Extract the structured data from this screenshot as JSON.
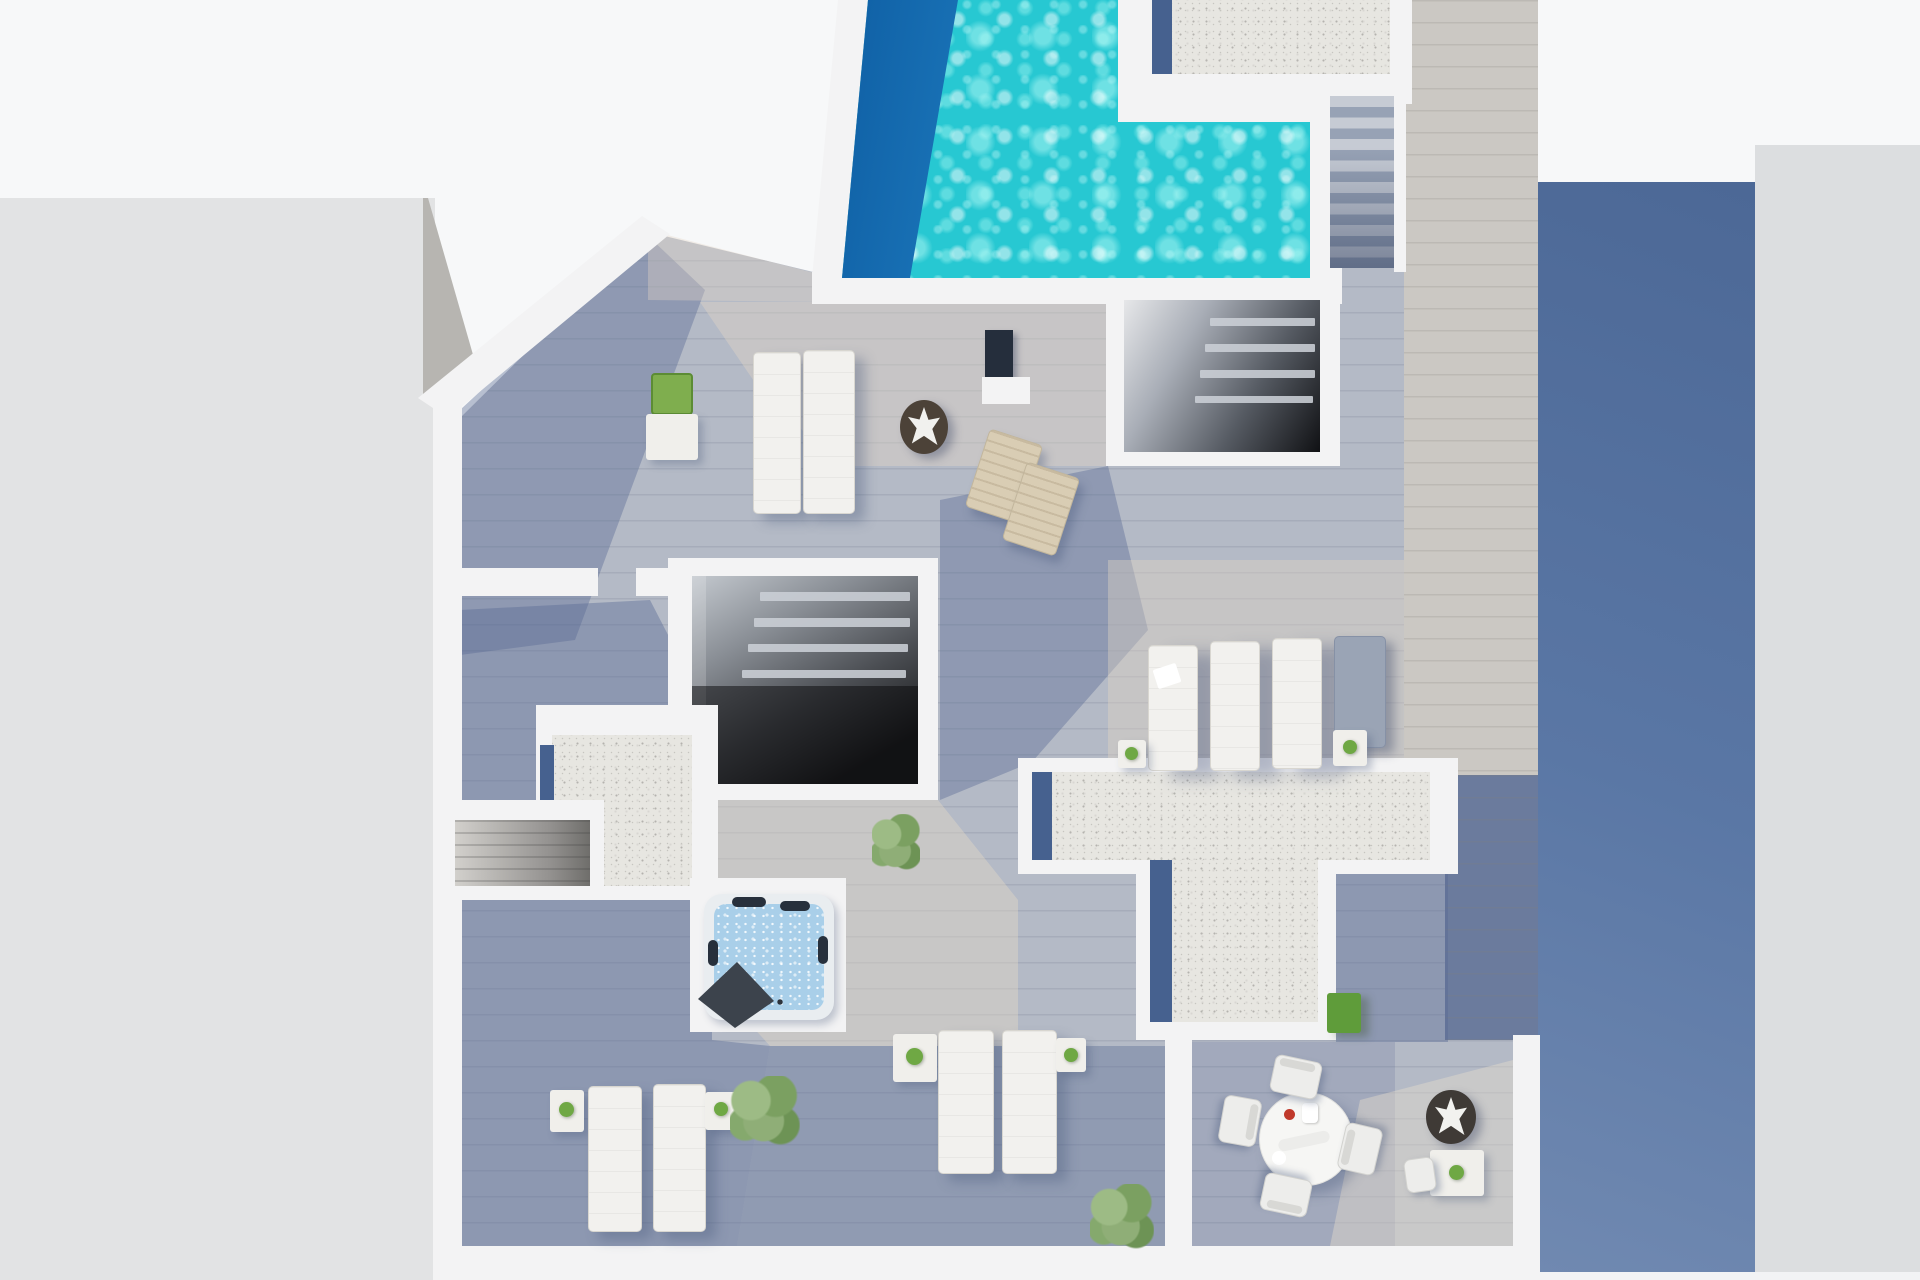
{
  "meta": {
    "title": "Top-down 3D render of a rooftop terrace floor plan",
    "render_width": 1920,
    "render_height": 1280,
    "visible_text": "none"
  },
  "palette": {
    "sky": "#f7f8f9",
    "left_building": "#e2e3e4",
    "left_building_facet": "#b7b5b1",
    "right_building": "#dcdee0",
    "wall_white": "#f3f3f4",
    "deck": "#b4bac6",
    "walkway_wood": "#cbc8c3",
    "walkway_shadow": "#6b7b9d",
    "pool_water": "#27c8d2",
    "pool_shadow_deep": "#1166a8",
    "gravel": "#e7e6e1",
    "gravel_shadow_strip": "#46618f",
    "stair_light": "#c6cbd4",
    "stair_dark": "#5d6b87",
    "room_interior_dark": "#1d1e20",
    "jacuzzi_shell": "#e9edf0",
    "jacuzzi_water": "#a9cfe9",
    "headrest_dark": "#27303c",
    "jacuzzi_cover": "#3c434c",
    "lounger_white": "#f2f1ee",
    "lounger_shadowed": "#9aa4b5",
    "wood_chair": "#d9cdb4",
    "plant_green": "#7fae4e",
    "plant_green_alt": "#6fa844",
    "grass_green": "#5f9c3a",
    "planter_dark": "#4c4238",
    "planter_dark2": "#3f3a36",
    "table_white": "#f0efeb",
    "towel_white": "#ffffff",
    "panel_navy": "#252e3c",
    "shadow_wall_blue_top": "#4c6896",
    "shadow_wall_blue_bottom": "#7089b1"
  },
  "scene": {
    "type": "architectural-3d-render",
    "view": "aerial top-down of a penthouse roof terrace between two neighboring buildings",
    "areas": [
      {
        "name": "swimming-pool",
        "shape": "L-shaped",
        "state": "sunlit with deep shadow along left edge"
      },
      {
        "name": "pool-deck",
        "material": "white stone apron"
      },
      {
        "name": "main-terrace-deck",
        "material": "grey wood planks with long diagonal shadows"
      },
      {
        "name": "gravel-roof-top-right",
        "material": "white gravel"
      },
      {
        "name": "gravel-roof-left",
        "material": "white gravel, L-shaped"
      },
      {
        "name": "gravel-roof-center",
        "material": "white gravel, T-shaped"
      },
      {
        "name": "stairwell-room-upper",
        "feature": "open roof with louvers over dark interior"
      },
      {
        "name": "lightwell-room-center",
        "feature": "open roof, dark interior with louvers"
      },
      {
        "name": "exterior-stairs",
        "steps": 8
      },
      {
        "name": "side-walkway",
        "material": "pale wood planks, partly in shadow"
      },
      {
        "name": "neighbor-building-left",
        "state": "flat light-grey roof"
      },
      {
        "name": "neighbor-building-right",
        "state": "light-grey roof with large slate-blue shaded wall"
      }
    ],
    "furniture": {
      "white_sun_loungers": 10,
      "wooden_deck_chairs": 2,
      "jacuzzi": 1,
      "dining_table_round": 1,
      "dining_chairs": 4,
      "side_tables": 8,
      "potted_plants": 9,
      "agave_planters": 2,
      "outdoor_shower_panel": 1,
      "towels": 1,
      "grass_patch": 1
    }
  }
}
